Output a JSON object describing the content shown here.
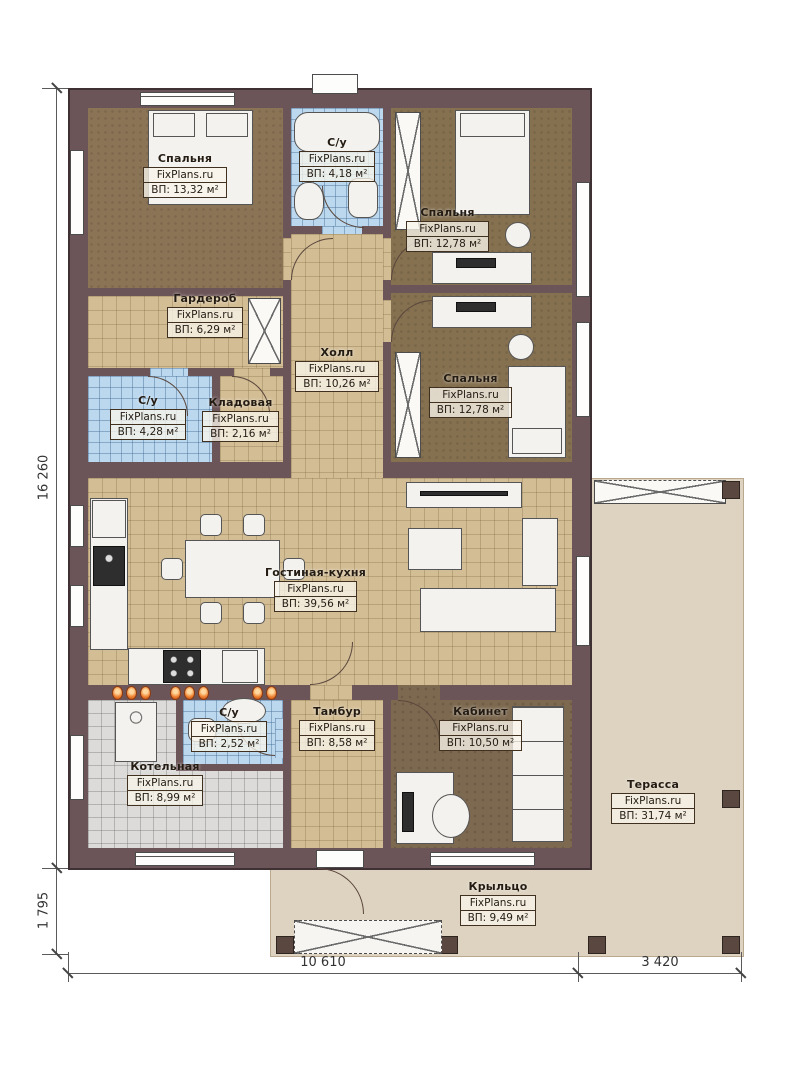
{
  "watermark": "FixPlans.ru",
  "rooms": [
    {
      "id": "bedroom1",
      "name": "Спальня",
      "area": "ВП: 13,32 м²"
    },
    {
      "id": "bath-top",
      "name": "С/у",
      "area": "ВП: 4,18 м²"
    },
    {
      "id": "bedroom2",
      "name": "Спальня",
      "area": "ВП: 12,78 м²"
    },
    {
      "id": "wardrobe",
      "name": "Гардероб",
      "area": "ВП: 6,29 м²"
    },
    {
      "id": "hall",
      "name": "Холл",
      "area": "ВП: 10,26 м²"
    },
    {
      "id": "bath-left",
      "name": "С/у",
      "area": "ВП: 4,28 м²"
    },
    {
      "id": "storage",
      "name": "Кладовая",
      "area": "ВП: 2,16 м²"
    },
    {
      "id": "bedroom3",
      "name": "Спальня",
      "area": "ВП: 12,78 м²"
    },
    {
      "id": "living-kitchen",
      "name": "Гостиная-кухня",
      "area": "ВП: 39,56 м²"
    },
    {
      "id": "boiler",
      "name": "Котельная",
      "area": "ВП: 8,99 м²"
    },
    {
      "id": "bath-bottom",
      "name": "С/у",
      "area": "ВП: 2,52 м²"
    },
    {
      "id": "vestibule",
      "name": "Тамбур",
      "area": "ВП: 8,58 м²"
    },
    {
      "id": "office",
      "name": "Кабинет",
      "area": "ВП: 10,50 м²"
    },
    {
      "id": "terrace",
      "name": "Терасса",
      "area": "ВП: 31,74 м²"
    },
    {
      "id": "porch",
      "name": "Крыльцо",
      "area": "ВП: 9,49 м²"
    }
  ],
  "dimensions": {
    "left_main": "16 260",
    "left_porch": "1 795",
    "bottom_left": "10 610",
    "bottom_right": "3 420"
  },
  "colors": {
    "wall": "#6c5558",
    "tile_tan": "#d3bd95",
    "carpet_brown": "#8b7356",
    "tile_blue": "#bcd8ee",
    "tile_gray": "#dcdbd9",
    "deck_beige": "#ded3c1",
    "radiator_orange": "#ef8434"
  }
}
